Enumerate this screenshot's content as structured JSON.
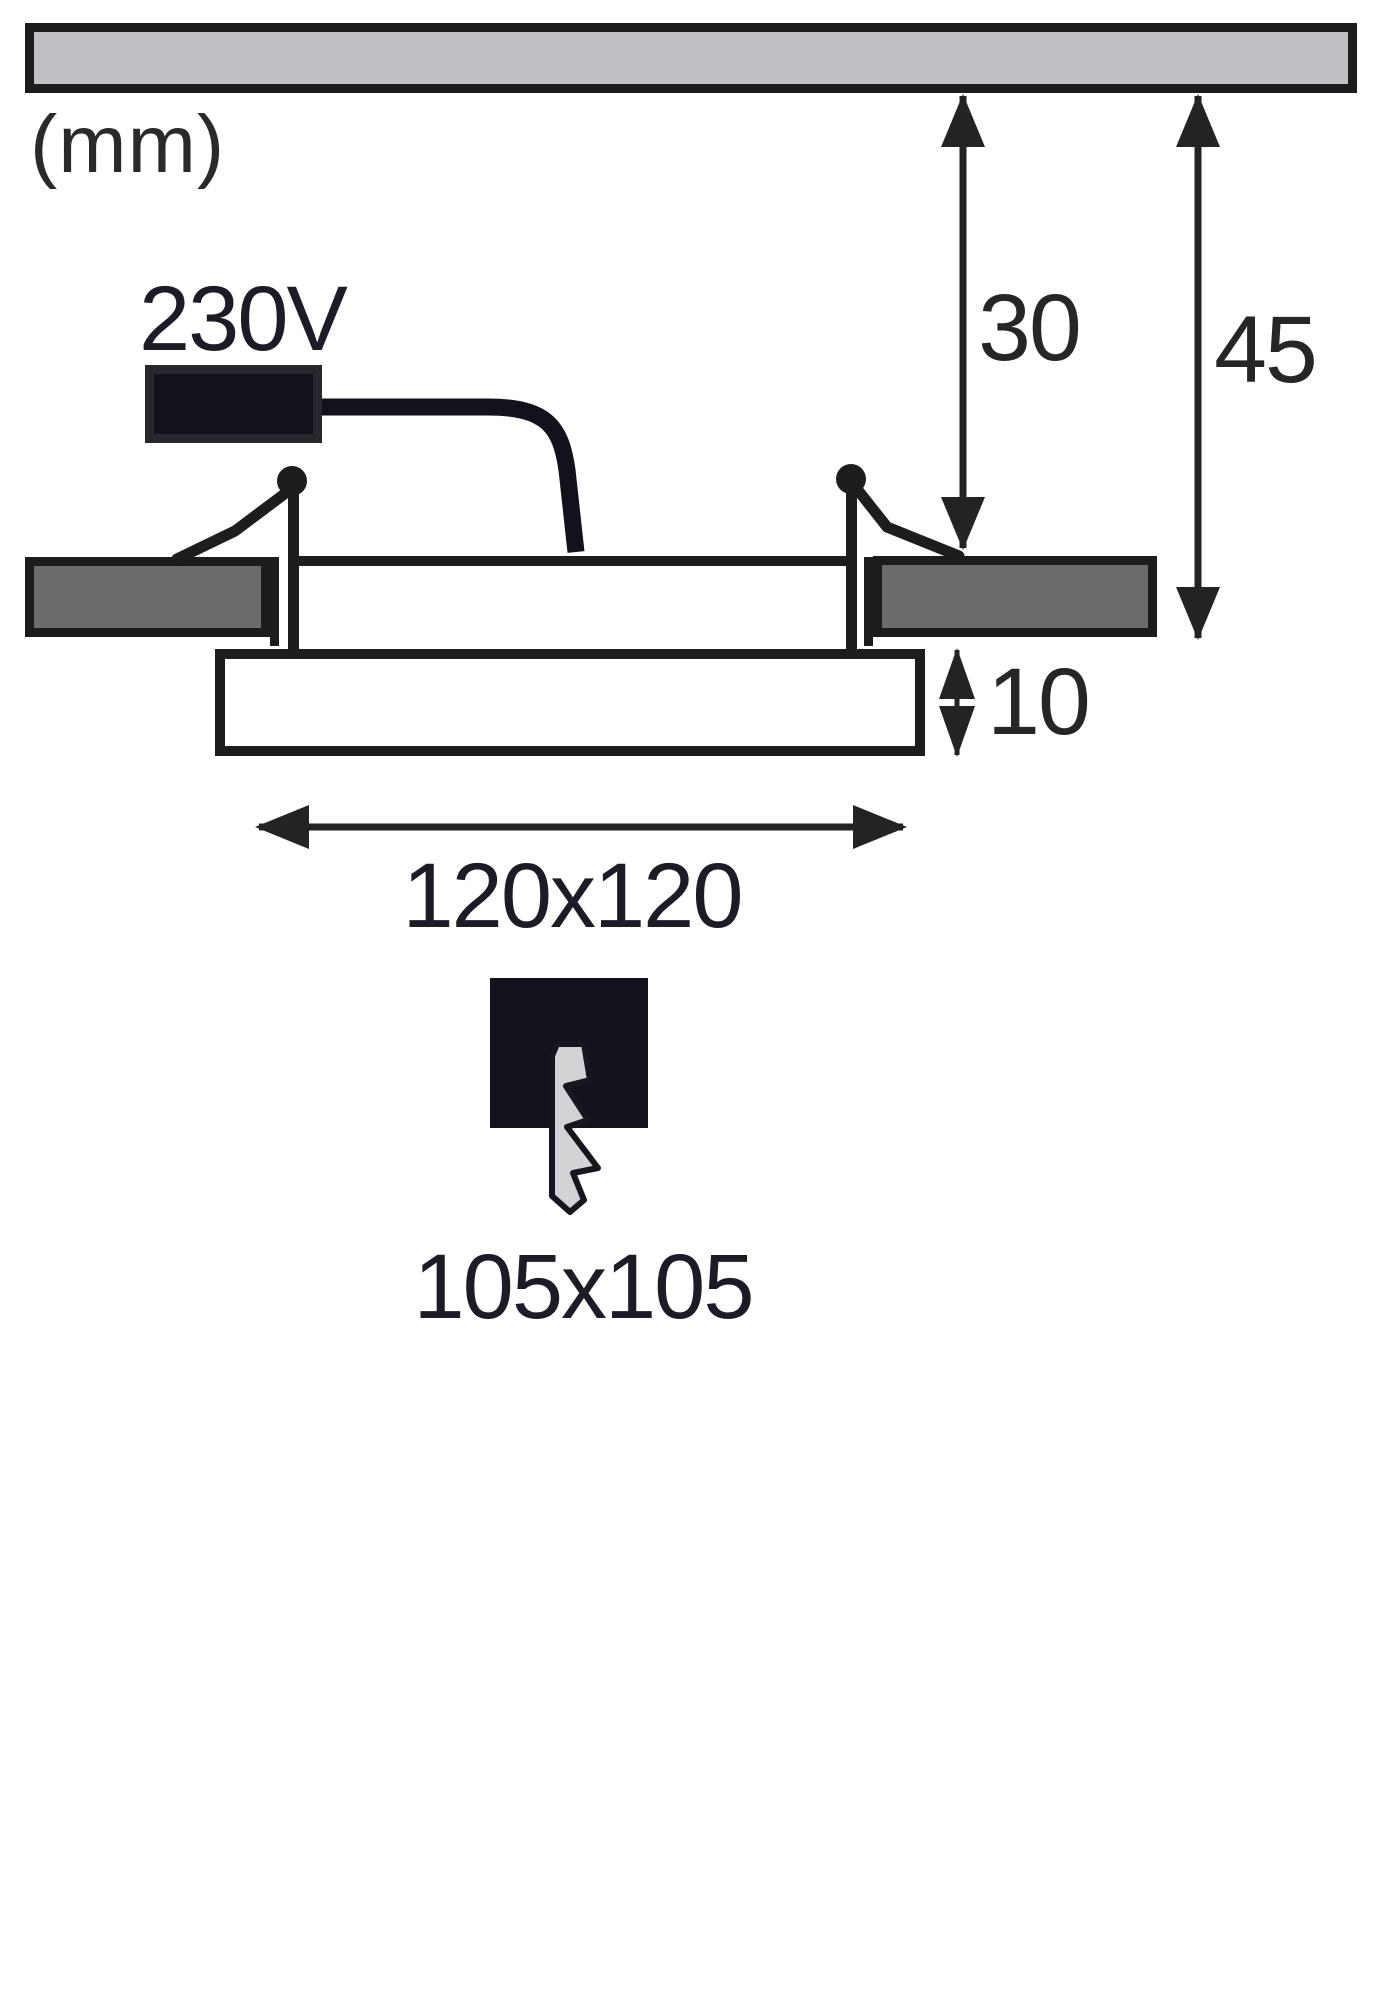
{
  "title": "Recessed LED panel installation dimension drawing",
  "unit_label": "(mm)",
  "voltage_label": "230V",
  "dimensions": {
    "recess_depth": "30",
    "total_depth": "45",
    "frame_height": "10",
    "panel_size": "120x120",
    "cutout_size": "105x105"
  },
  "icons": {
    "cutout_symbol": "lightning-bolt-icon"
  },
  "colors": {
    "ink": "#222222",
    "dark_fill": "#12121c",
    "ceiling_fill": "#c0c0c4",
    "panel_fill": "#6b6b6b",
    "bolt_fill": "#d3d3d5",
    "background": "#ffffff"
  }
}
